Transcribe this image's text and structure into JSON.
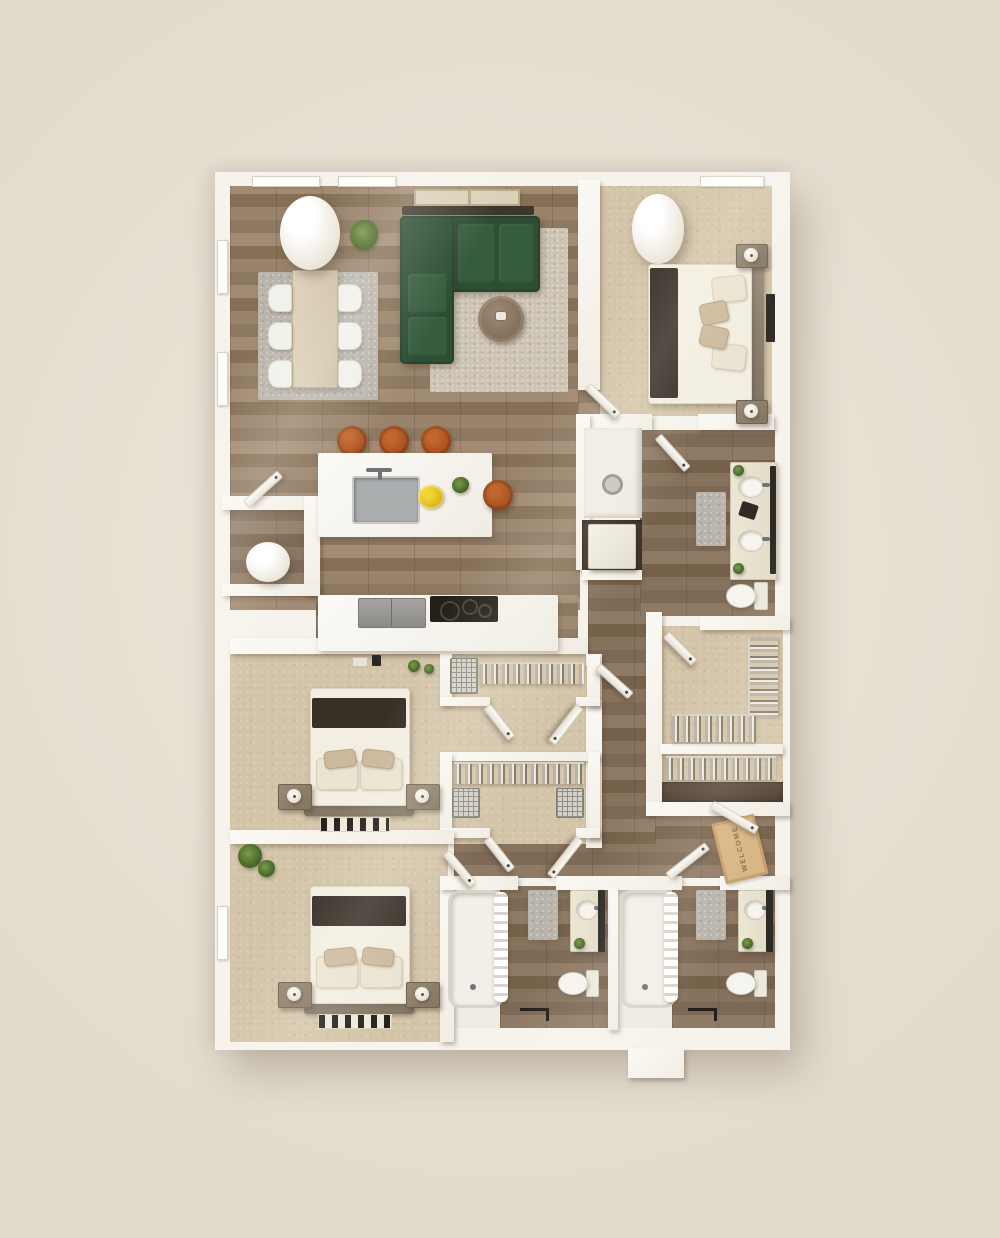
{
  "scene": {
    "type": "3d-floor-plan-top-down-render",
    "style": "photorealistic apartment floor plan, three bedrooms, three bathrooms",
    "door_mat_text": "WELCOME",
    "palette": {
      "background": "#eae3d6",
      "wall": "#f8f5ef",
      "wood_floor": "#97826c",
      "wood_floor_dark": "#85705a",
      "carpet": "#d4c5a9",
      "sofa_green": "#2d4e35",
      "stool_cognac": "#a9531f",
      "bed_blanket": "#382f27",
      "rug_gray": "#bab5ac",
      "living_rug": "#cdc4b3",
      "vanity_cream": "#e8e2d0",
      "mirror_dark": "#2e2a25",
      "door_mat": "#d8b584",
      "plant_green": "#4a6a2c",
      "lemon_yellow": "#e4c11f"
    }
  },
  "rooms": [
    {
      "name": "living-dining-room",
      "floor": "hardwood",
      "contents": [
        "dining-table",
        "six-dining-chairs",
        "gray-area-rug",
        "green-l-shaped-sectional-sofa",
        "round-coffee-table",
        "textured-area-rug",
        "potted-plant",
        "structural-column",
        "tv-shadow-line",
        "window-shade-panels"
      ]
    },
    {
      "name": "kitchen",
      "floor": "hardwood",
      "contents": [
        "island-with-sink-and-faucet",
        "bowl-of-lemons",
        "small-plant",
        "four-cognac-bar-stools",
        "counter-run",
        "refrigerator",
        "cooktop",
        "small-appliances"
      ]
    },
    {
      "name": "utility-closet",
      "floor": "hardwood",
      "contents": [
        "water-heater"
      ]
    },
    {
      "name": "bedroom-1",
      "floor": "carpet",
      "contents": [
        "queen-bed",
        "dark-throw-blanket",
        "two-nightstands",
        "two-table-lamps",
        "structural-column",
        "wall-art"
      ]
    },
    {
      "name": "bathroom-1",
      "floor": "hardwood",
      "contents": [
        "walk-in-shower-with-drain",
        "storage-cabinet",
        "double-sink-vanity",
        "toilet",
        "gray-bath-rug",
        "two-small-plants"
      ]
    },
    {
      "name": "walk-in-closet",
      "floor": "carpet",
      "contents": [
        "hanging-clothes-rack-east",
        "hanging-clothes-rack-south"
      ]
    },
    {
      "name": "linen-closet",
      "floor": "carpet",
      "contents": [
        "hanging-clothes-rack",
        "dark-wood-shelf"
      ]
    },
    {
      "name": "bedroom-2",
      "floor": "carpet",
      "contents": [
        "queen-bed",
        "dark-throw-blanket",
        "two-nightstands",
        "two-table-lamps",
        "patterned-accent-rug",
        "reach-in-closet-a",
        "reach-in-closet-b",
        "wire-baskets"
      ]
    },
    {
      "name": "bedroom-3",
      "floor": "carpet",
      "contents": [
        "queen-bed",
        "dark-throw-blanket",
        "two-nightstands",
        "two-table-lamps",
        "patterned-accent-rug",
        "potted-plants"
      ]
    },
    {
      "name": "bathroom-2",
      "floor": "hardwood",
      "contents": [
        "bathtub",
        "shower-curtain",
        "vanity-with-sink",
        "mirror",
        "toilet",
        "gray-bath-rug",
        "small-plant",
        "door-swing-mark"
      ]
    },
    {
      "name": "bathroom-3",
      "floor": "hardwood",
      "contents": [
        "bathtub",
        "shower-curtain",
        "vanity-with-sink",
        "mirror",
        "toilet",
        "gray-bath-rug",
        "small-plant",
        "door-swing-mark"
      ]
    },
    {
      "name": "entry",
      "floor": "hardwood",
      "contents": [
        "welcome-door-mat",
        "entry-door",
        "entry-step"
      ]
    }
  ]
}
